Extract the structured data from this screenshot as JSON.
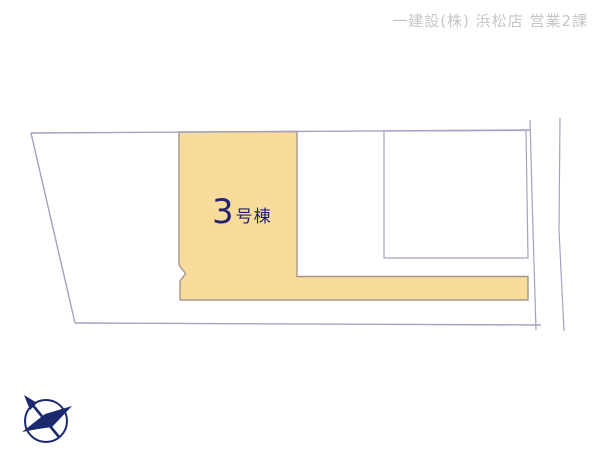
{
  "header": {
    "branch_label": "一建設(株) 浜松店 営業2課"
  },
  "plan": {
    "highlighted_lot": {
      "label_number": "3",
      "label_suffix": "号棟",
      "full_label": "3号棟",
      "highlighted": true
    },
    "icons": {
      "compass": "north-compass-icon"
    }
  },
  "colors": {
    "highlight_fill": "#f9db9b",
    "highlight_stroke": "#a6968a",
    "boundary_line": "#a2a2c4",
    "label_text": "#22246d",
    "header_text": "#c6c6c6",
    "compass": "#1b2a6e",
    "background": "#ffffff"
  }
}
